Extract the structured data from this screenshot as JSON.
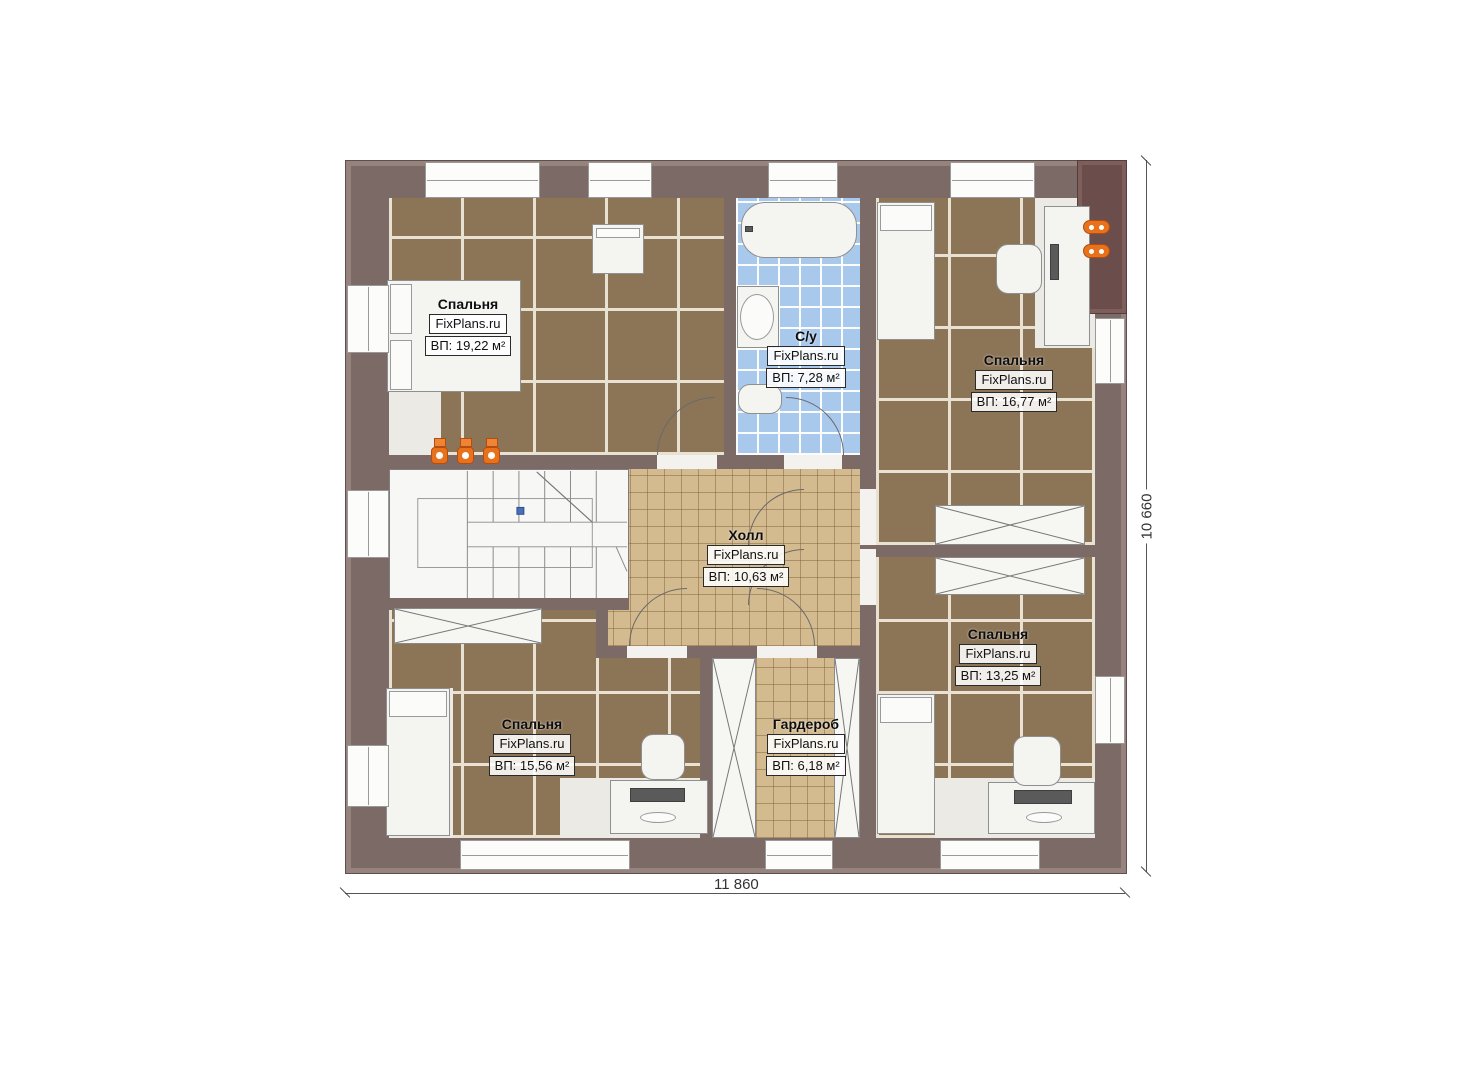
{
  "plan": {
    "rooms": [
      {
        "key": "bedroom_tl",
        "name": "Спальня",
        "brand": "FixPlans.ru",
        "area": "ВП: 19,22 м²"
      },
      {
        "key": "bathroom",
        "name": "С/у",
        "brand": "FixPlans.ru",
        "area": "ВП: 7,28 м²"
      },
      {
        "key": "bedroom_tr",
        "name": "Спальня",
        "brand": "FixPlans.ru",
        "area": "ВП: 16,77 м²"
      },
      {
        "key": "hall",
        "name": "Холл",
        "brand": "FixPlans.ru",
        "area": "ВП: 10,63 м²"
      },
      {
        "key": "bedroom_bl",
        "name": "Спальня",
        "brand": "FixPlans.ru",
        "area": "ВП: 15,56 м²"
      },
      {
        "key": "wardrobe",
        "name": "Гардероб",
        "brand": "FixPlans.ru",
        "area": "ВП: 6,18 м²"
      },
      {
        "key": "bedroom_br",
        "name": "Спальня",
        "brand": "FixPlans.ru",
        "area": "ВП: 13,25 м²"
      }
    ],
    "dimensions": {
      "width": "11 860",
      "height": "10 660"
    },
    "colors": {
      "wall": "#7c6a66",
      "wall_dark": "#6b4e4c",
      "floor_bedroom": "#8c7457",
      "floor_hall": "#d4ba8f",
      "floor_bath": "#a9c9ec",
      "radiator": "#e8721c"
    }
  }
}
